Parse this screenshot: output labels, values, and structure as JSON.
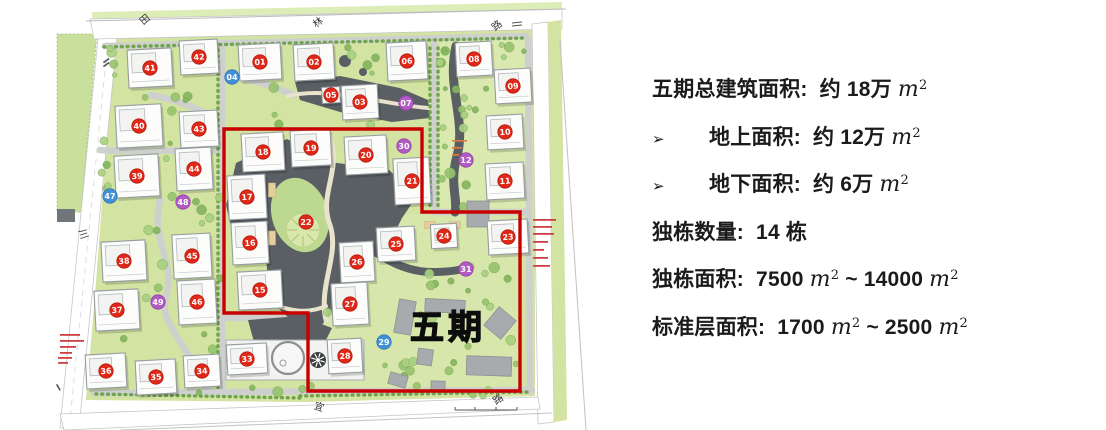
{
  "panel": {
    "m2": {
      "base": "m",
      "sup": "2"
    },
    "lines": [
      {
        "bullet": null,
        "segs": [
          {
            "t": "五期总建筑面积:  约 18万 "
          },
          {
            "m2": true
          }
        ]
      },
      {
        "bullet": "➢",
        "segs": [
          {
            "t": "地上面积:  约 12万 "
          },
          {
            "m2": true
          }
        ]
      },
      {
        "bullet": "➢",
        "segs": [
          {
            "t": "地下面积:  约 6万 "
          },
          {
            "m2": true
          }
        ]
      },
      {
        "bullet": null,
        "segs": [
          {
            "t": "独栋数量:  14 栋"
          }
        ]
      },
      {
        "bullet": null,
        "segs": [
          {
            "t": "独栋面积:  7500 "
          },
          {
            "m2": true
          },
          {
            "t": " ~ 14000 "
          },
          {
            "m2": true
          }
        ]
      },
      {
        "bullet": null,
        "segs": [
          {
            "t": "标准层面积:  1700 "
          },
          {
            "m2": true
          },
          {
            "t": " ~ 2500 "
          },
          {
            "m2": true
          }
        ]
      }
    ]
  },
  "map": {
    "phase_label": {
      "text": "五期",
      "x": 410,
      "y": 339,
      "size": 34
    },
    "boundary": "224,129 422,129 422,212 520,212 520,391 308,391 308,313 224,313",
    "road_labels": [
      {
        "t": "田",
        "x": 147,
        "y": 22,
        "r": -40
      },
      {
        "t": "林",
        "x": 320,
        "y": 25,
        "r": -38
      },
      {
        "t": "路",
        "x": 499,
        "y": 28,
        "r": -40
      },
      {
        "t": "川",
        "x": 80,
        "y": 235,
        "r": 72
      },
      {
        "t": "宜",
        "x": 318,
        "y": 410,
        "r": 18
      },
      {
        "t": "路",
        "x": 500,
        "y": 402,
        "r": -35
      }
    ],
    "buildings": [
      {
        "n": "41",
        "x": 150,
        "y": 68,
        "w": 44,
        "h": 38
      },
      {
        "n": "42",
        "x": 199,
        "y": 57,
        "w": 38,
        "h": 34
      },
      {
        "n": "01",
        "x": 260,
        "y": 62,
        "w": 42,
        "h": 36
      },
      {
        "n": "02",
        "x": 314,
        "y": 62,
        "w": 40,
        "h": 36
      },
      {
        "n": "05",
        "x": 331,
        "y": 95,
        "w": 18,
        "h": 16
      },
      {
        "n": "03",
        "x": 360,
        "y": 102,
        "w": 36,
        "h": 34
      },
      {
        "n": "06",
        "x": 407,
        "y": 61,
        "w": 40,
        "h": 38
      },
      {
        "n": "08",
        "x": 474,
        "y": 59,
        "w": 36,
        "h": 34
      },
      {
        "n": "09",
        "x": 513,
        "y": 86,
        "w": 36,
        "h": 34
      },
      {
        "n": "10",
        "x": 505,
        "y": 132,
        "w": 36,
        "h": 34
      },
      {
        "n": "11",
        "x": 505,
        "y": 181,
        "w": 38,
        "h": 36
      },
      {
        "n": "40",
        "x": 139,
        "y": 126,
        "w": 46,
        "h": 42
      },
      {
        "n": "43",
        "x": 199,
        "y": 129,
        "w": 38,
        "h": 36
      },
      {
        "n": "39",
        "x": 137,
        "y": 176,
        "w": 44,
        "h": 42
      },
      {
        "n": "44",
        "x": 194,
        "y": 169,
        "w": 36,
        "h": 42
      },
      {
        "n": "38",
        "x": 124,
        "y": 261,
        "w": 44,
        "h": 40
      },
      {
        "n": "45",
        "x": 192,
        "y": 256,
        "w": 38,
        "h": 44
      },
      {
        "n": "37",
        "x": 117,
        "y": 310,
        "w": 44,
        "h": 40
      },
      {
        "n": "46",
        "x": 197,
        "y": 302,
        "w": 38,
        "h": 44
      },
      {
        "n": "36",
        "x": 106,
        "y": 371,
        "w": 40,
        "h": 34
      },
      {
        "n": "35",
        "x": 156,
        "y": 377,
        "w": 40,
        "h": 34
      },
      {
        "n": "34",
        "x": 202,
        "y": 371,
        "w": 36,
        "h": 32
      },
      {
        "n": "33",
        "x": 247,
        "y": 359,
        "w": 40,
        "h": 30
      },
      {
        "n": "18",
        "x": 263,
        "y": 152,
        "w": 42,
        "h": 38
      },
      {
        "n": "19",
        "x": 311,
        "y": 148,
        "w": 40,
        "h": 36
      },
      {
        "n": "20",
        "x": 366,
        "y": 155,
        "w": 42,
        "h": 38
      },
      {
        "n": "21",
        "x": 412,
        "y": 181,
        "w": 36,
        "h": 46
      },
      {
        "n": "17",
        "x": 247,
        "y": 197,
        "w": 38,
        "h": 44
      },
      {
        "n": "16",
        "x": 250,
        "y": 243,
        "w": 36,
        "h": 42
      },
      {
        "n": "15",
        "x": 260,
        "y": 290,
        "w": 44,
        "h": 38
      },
      {
        "n": "25",
        "x": 396,
        "y": 244,
        "w": 38,
        "h": 34
      },
      {
        "n": "26",
        "x": 357,
        "y": 262,
        "w": 34,
        "h": 40
      },
      {
        "n": "27",
        "x": 350,
        "y": 304,
        "w": 36,
        "h": 42
      },
      {
        "n": "24",
        "x": 444,
        "y": 236,
        "w": 26,
        "h": 24
      },
      {
        "n": "23",
        "x": 508,
        "y": 237,
        "w": 40,
        "h": 34
      },
      {
        "n": "28",
        "x": 345,
        "y": 356,
        "w": 34,
        "h": 34
      }
    ],
    "markers": [
      {
        "n": "04",
        "x": 232,
        "y": 77,
        "c": "blue"
      },
      {
        "n": "47",
        "x": 110,
        "y": 196,
        "c": "blue"
      },
      {
        "n": "29",
        "x": 384,
        "y": 342,
        "c": "blue"
      },
      {
        "n": "07",
        "x": 406,
        "y": 103,
        "c": "purple"
      },
      {
        "n": "12",
        "x": 466,
        "y": 160,
        "c": "purple"
      },
      {
        "n": "30",
        "x": 404,
        "y": 146,
        "c": "purple"
      },
      {
        "n": "31",
        "x": 466,
        "y": 269,
        "c": "purple"
      },
      {
        "n": "48",
        "x": 183,
        "y": 202,
        "c": "purple"
      },
      {
        "n": "49",
        "x": 158,
        "y": 302,
        "c": "purple"
      },
      {
        "n": "22",
        "x": 306,
        "y": 222,
        "c": "red"
      }
    ],
    "colors": {
      "site": "#d2e3a2",
      "lawn": "#d9e9b0",
      "field": "#c9e09c",
      "plaza": "#5a5f64",
      "road": "#cdd0cd",
      "road_edge": "#c6c6c6",
      "building_fill": "#fcfcfb",
      "building_stroke": "#969ca0",
      "red": "#e02818",
      "blue": "#4191d6",
      "purple": "#b05cc2",
      "boundary": "#c80000",
      "tree1": "#84b55e",
      "tree2": "#97c46e",
      "tree3": "#a8d080",
      "path": "#e9e2cc",
      "slab": "#f2f3f1",
      "gray_building": "#a7abad",
      "tan": "#e6cf9d",
      "label": "#3a3a3a",
      "note_red": "#d04040",
      "note_orange": "#e07840"
    }
  }
}
